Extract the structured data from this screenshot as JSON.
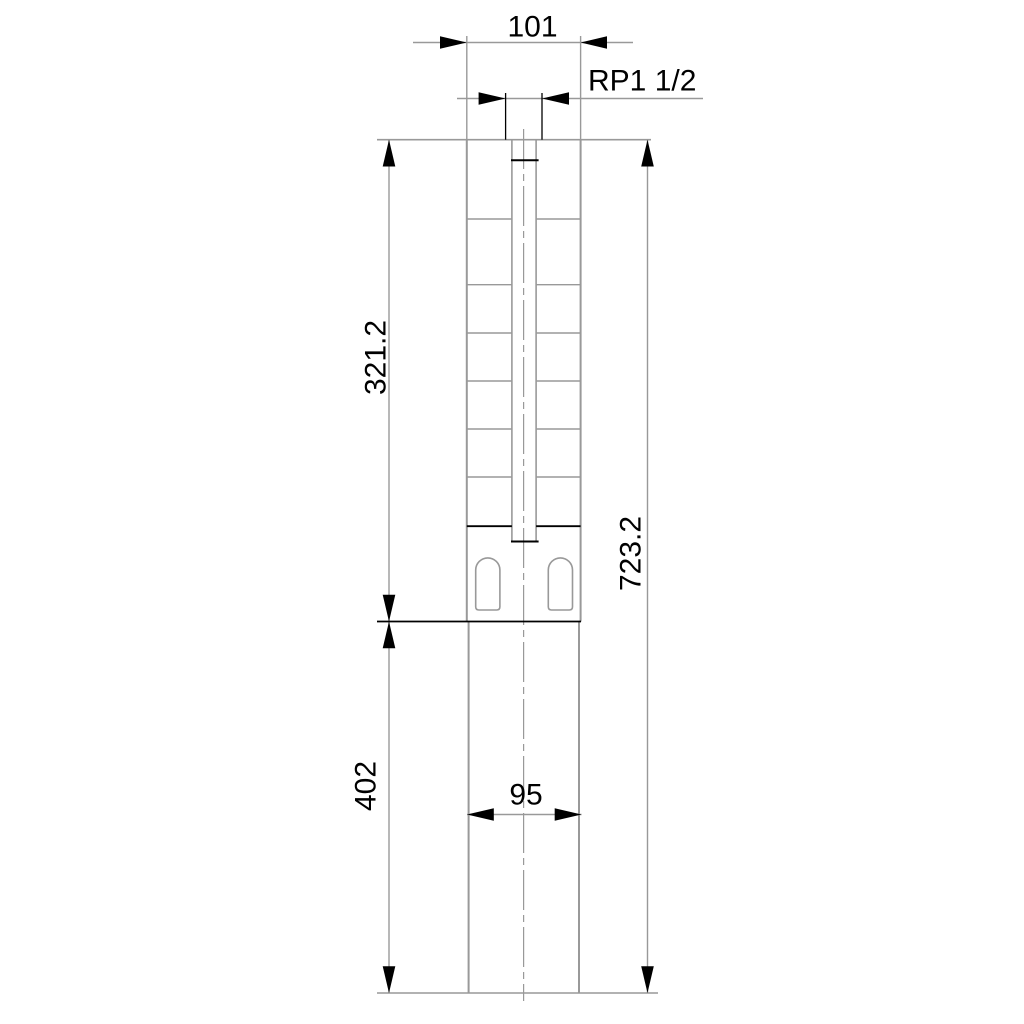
{
  "drawing": {
    "type": "technical-dimension-drawing",
    "dims": {
      "top_width": "101",
      "thread": "RP1 1/2",
      "upper_height": "321.2",
      "total_height": "723.2",
      "lower_height": "402",
      "lower_width": "95"
    },
    "colors": {
      "line": "#999999",
      "black": "#000000",
      "text": "#000000",
      "background": "#ffffff"
    }
  }
}
